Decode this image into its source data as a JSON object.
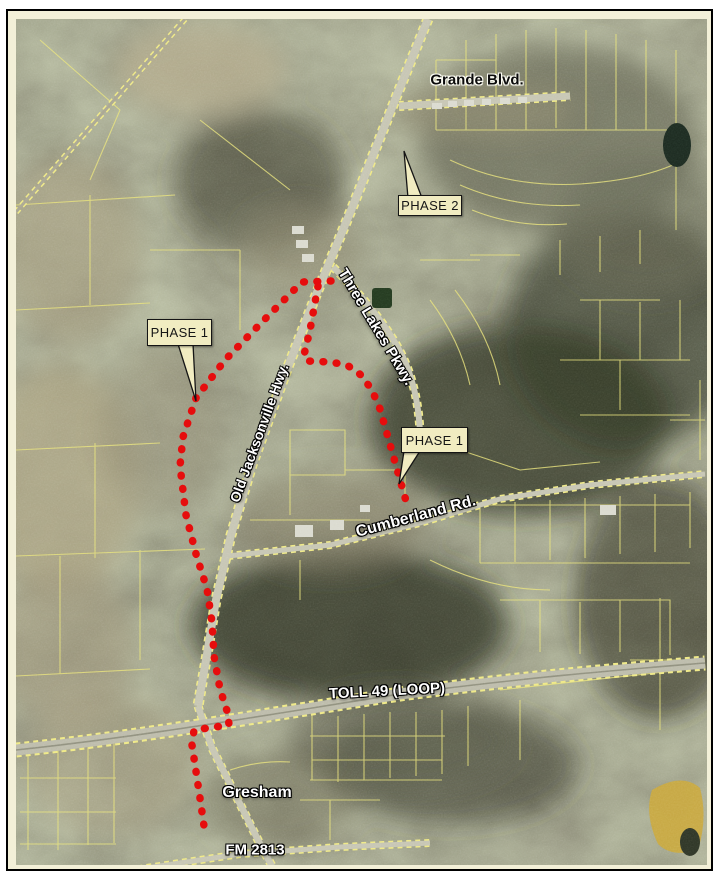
{
  "figure": {
    "kind": "aerial-map-exhibit",
    "frame_color": "#000000",
    "mat_color": "#f3f0d8"
  },
  "road_labels": [
    {
      "id": "grande-blvd",
      "text": "Grande Blvd.",
      "x": 477,
      "y": 80,
      "rotate": 0,
      "size": 15,
      "variant": "dark"
    },
    {
      "id": "three-lakes-pkwy",
      "text": "Three Lakes Pkwy.",
      "x": 376,
      "y": 327,
      "rotate": 59,
      "size": 15,
      "variant": "light"
    },
    {
      "id": "old-jacksonville-hwy",
      "text": "Old Jacksonville Hwy.",
      "x": 259,
      "y": 433,
      "rotate": -70,
      "size": 14,
      "variant": "light"
    },
    {
      "id": "cumberland-rd",
      "text": "Cumberland Rd.",
      "x": 416,
      "y": 517,
      "rotate": -15,
      "size": 16,
      "variant": "light"
    },
    {
      "id": "toll-49-loop",
      "text": "TOLL 49 (LOOP)",
      "x": 387,
      "y": 691,
      "rotate": -3,
      "size": 15,
      "variant": "light"
    },
    {
      "id": "gresham",
      "text": "Gresham",
      "x": 257,
      "y": 793,
      "rotate": 0,
      "size": 16,
      "variant": "light"
    },
    {
      "id": "fm-2813",
      "text": "FM 2813",
      "x": 255,
      "y": 850,
      "rotate": 0,
      "size": 15,
      "variant": "light"
    }
  ],
  "callouts": [
    {
      "id": "phase-2",
      "text": "PHASE 2",
      "x": 398,
      "y": 195,
      "w": 64,
      "h": 21,
      "pointer": [
        [
          404,
          151
        ],
        [
          408,
          198
        ],
        [
          422,
          198
        ]
      ]
    },
    {
      "id": "phase-1-west",
      "text": "PHASE 1",
      "x": 147,
      "y": 319,
      "w": 65,
      "h": 27,
      "pointer": [
        [
          196,
          401
        ],
        [
          178,
          344
        ],
        [
          193,
          344
        ]
      ]
    },
    {
      "id": "phase-1-east",
      "text": "PHASE 1",
      "x": 401,
      "y": 427,
      "w": 67,
      "h": 26,
      "pointer": [
        [
          399,
          484
        ],
        [
          404,
          451
        ],
        [
          420,
          451
        ]
      ]
    }
  ],
  "route": {
    "description": "dotted red proposed alignment",
    "color": "#e60d0d",
    "dot_size": 7.5,
    "paths": [
      {
        "id": "route-west",
        "points": [
          [
            331,
            281
          ],
          [
            302,
            282
          ],
          [
            262,
            322
          ],
          [
            225,
            360
          ],
          [
            196,
            398
          ],
          [
            183,
            437
          ],
          [
            180,
            466
          ],
          [
            186,
            515
          ],
          [
            196,
            554
          ],
          [
            207,
            589
          ],
          [
            212,
            622
          ],
          [
            214,
            656
          ],
          [
            220,
            689
          ],
          [
            228,
            714
          ],
          [
            229,
            725
          ],
          [
            194,
            730
          ],
          [
            192,
            745
          ],
          [
            197,
            778
          ],
          [
            201,
            805
          ],
          [
            205,
            833
          ]
        ]
      },
      {
        "id": "route-east",
        "points": [
          [
            318,
            286
          ],
          [
            310,
            330
          ],
          [
            304,
            355
          ],
          [
            307,
            361
          ],
          [
            330,
            362
          ],
          [
            347,
            365
          ],
          [
            361,
            375
          ],
          [
            372,
            390
          ],
          [
            380,
            409
          ],
          [
            408,
            508
          ]
        ]
      }
    ]
  },
  "callout_style": {
    "fill": "#f1ecc1",
    "stroke": "#151515"
  }
}
